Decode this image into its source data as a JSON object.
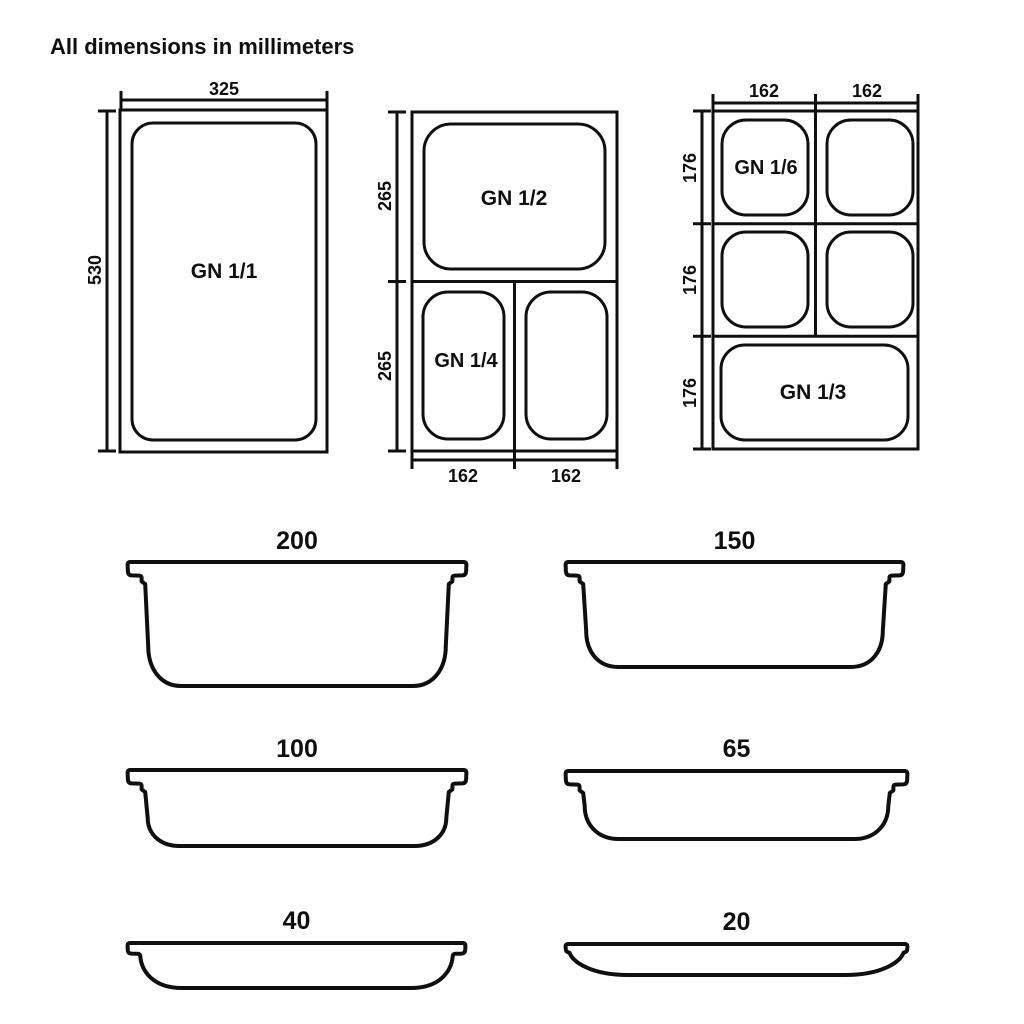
{
  "title": "All dimensions in millimeters",
  "colors": {
    "line": "#0f0f0f",
    "background": "#ffffff"
  },
  "top_view_1": {
    "label": "GN 1/1",
    "width": "325",
    "height": "530"
  },
  "top_view_2": {
    "label_top": "GN 1/2",
    "label_bottom_left": "GN 1/4",
    "height_top": "265",
    "height_bottom": "265",
    "width_left": "162",
    "width_right": "162"
  },
  "top_view_3": {
    "label_top_left": "GN 1/6",
    "label_bottom": "GN 1/3",
    "height_row1": "176",
    "height_row2": "176",
    "height_row3": "176",
    "width_left": "162",
    "width_right": "162"
  },
  "profile_depths": {
    "p200": "200",
    "p150": "150",
    "p100": "100",
    "p65": "65",
    "p40": "40",
    "p20": "20"
  }
}
